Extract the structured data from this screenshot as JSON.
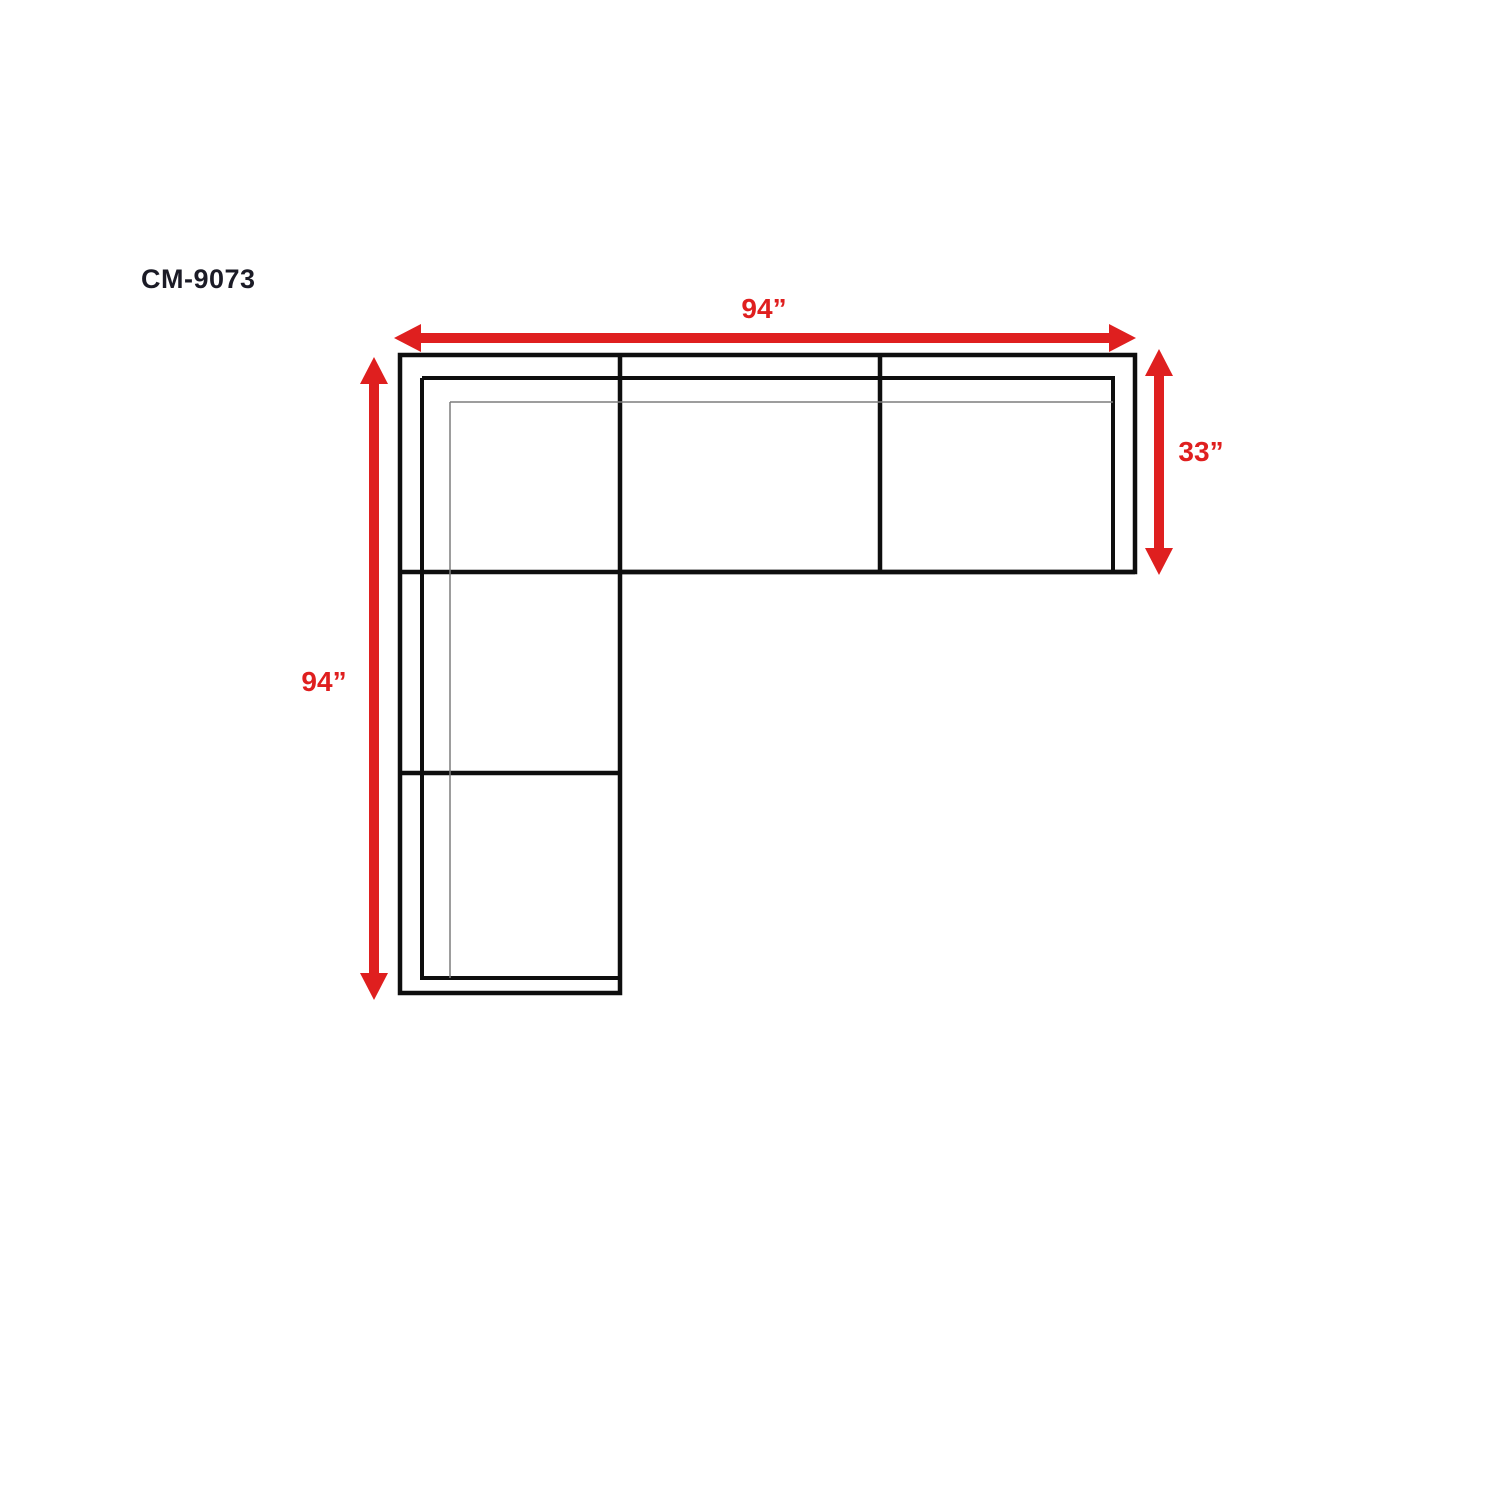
{
  "diagram": {
    "model": "CM-9073",
    "type": "sectional-sofa-top-view",
    "dimensions": {
      "width": "94”",
      "depth": "33”",
      "length": "94”"
    },
    "colors": {
      "arrow_red": "#df1f1f",
      "outline_black": "#0e0e0e",
      "detail_gray": "#7d7d7d",
      "model_text": "#1b1b26",
      "background": "#ffffff"
    }
  }
}
